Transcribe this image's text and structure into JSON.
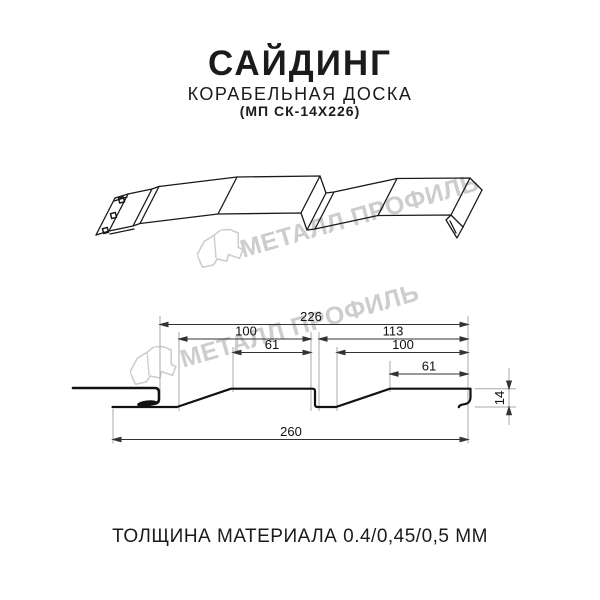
{
  "header": {
    "title": "САЙДИНГ",
    "subtitle": "КОРАБЕЛЬНАЯ ДОСКА",
    "product_code": "(МП СК-14Х226)"
  },
  "watermarks": {
    "text": "МЕТАЛЛ ПРОФИЛЬ",
    "color": "#cdcdcd",
    "logo_icon": "metall-profil-house-logo"
  },
  "section_drawing": {
    "units": "mm",
    "dimensions": {
      "overall_top": "226",
      "left_pitch": "100",
      "left_plateau": "61",
      "right_pitch": "113",
      "right_inner": "100",
      "right_plateau": "61",
      "overall_bottom": "260",
      "profile_height": "14"
    }
  },
  "footer": {
    "thickness_note": "ТОЛЩИНА МАТЕРИАЛА 0.4/0,45/0,5 ММ"
  }
}
